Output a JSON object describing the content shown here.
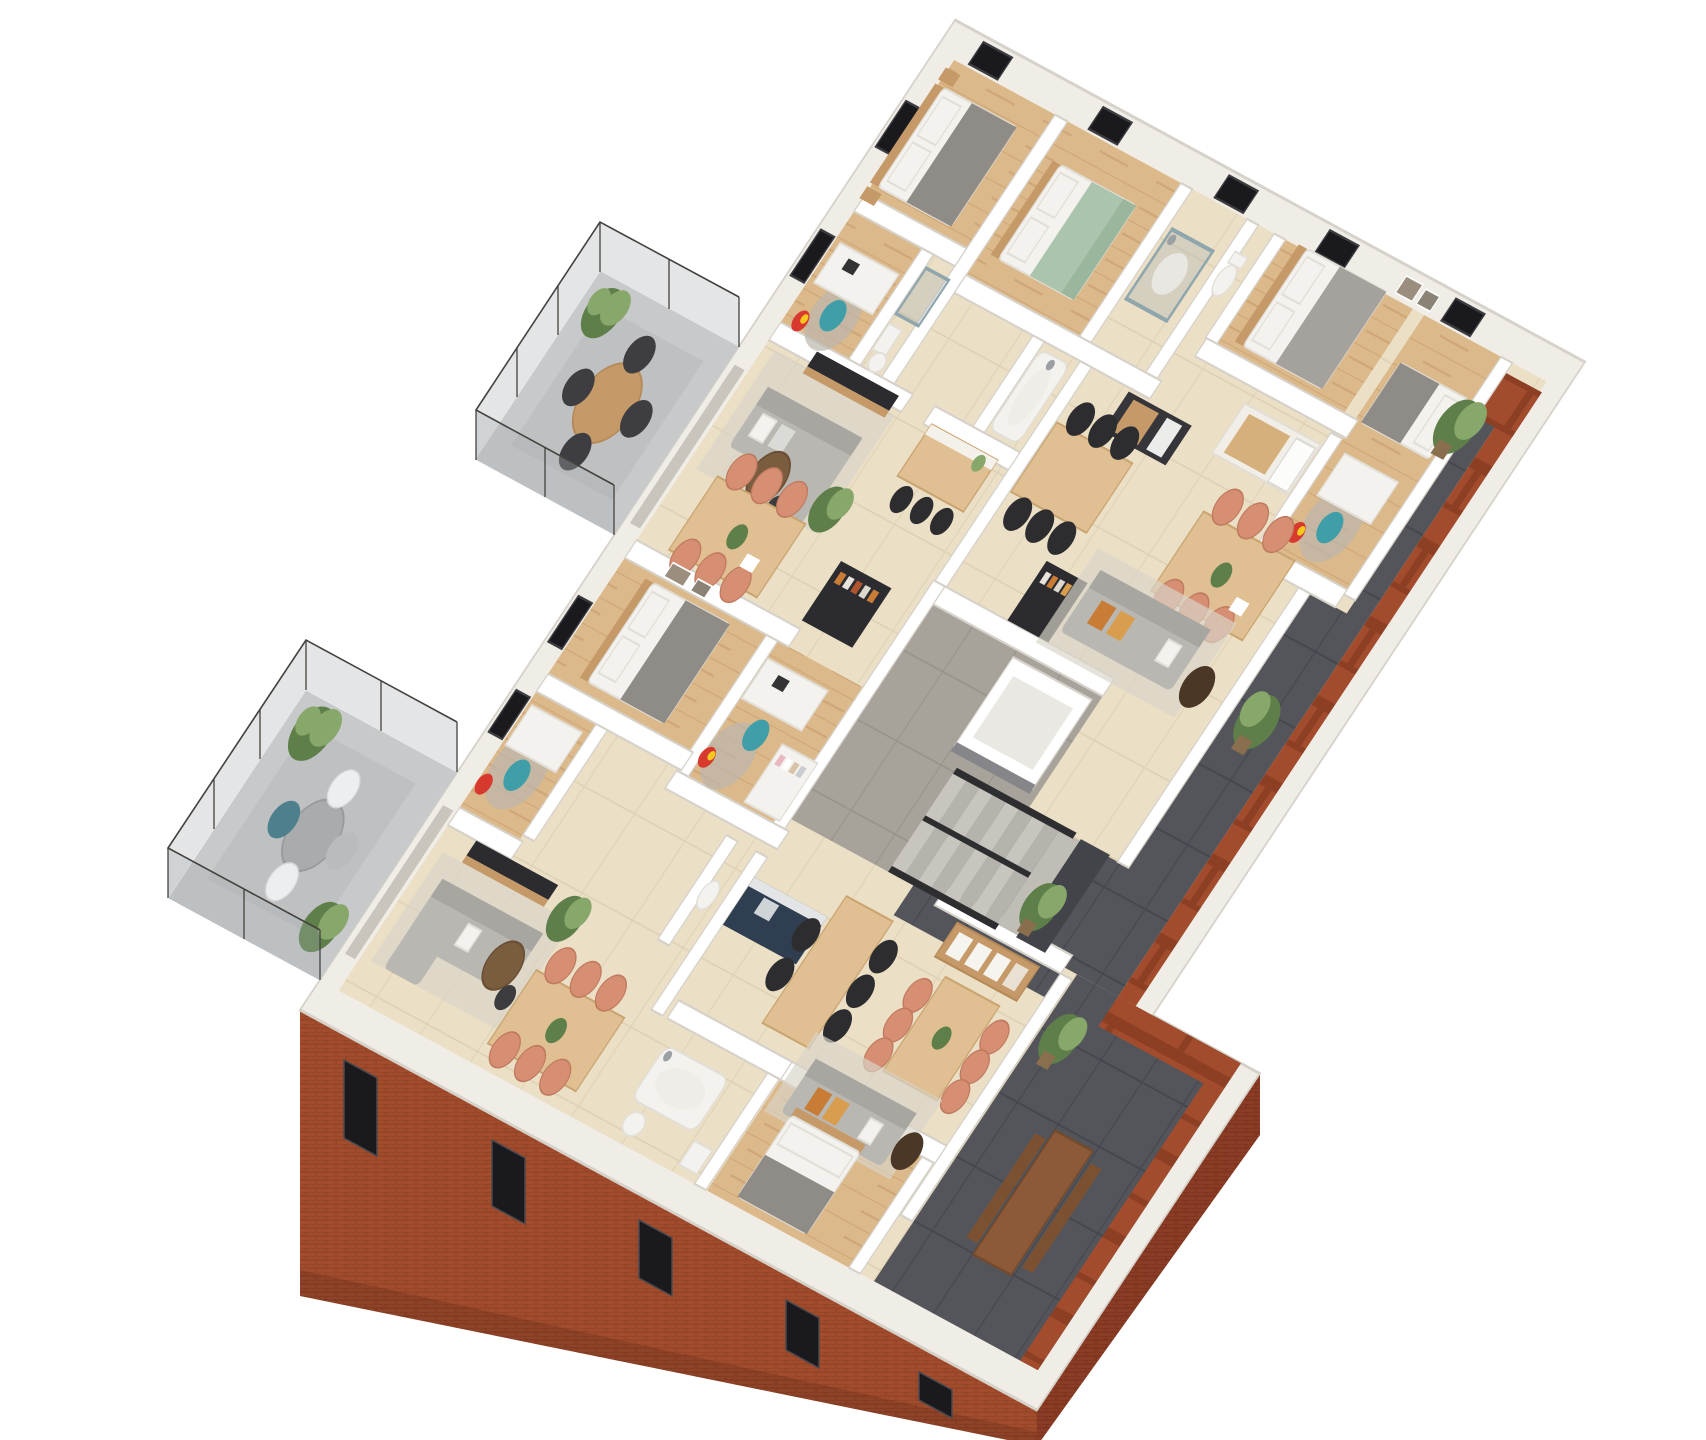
{
  "title": "3D isometric cutaway floor plan rendering of an apartment storey",
  "scene": {
    "description": "Photorealistic top-down 3D cutaway floor plan rotated diagonally: red brick exterior facade with dark windows, white interior walls, cream tile and light wood floors, two protruding glass-railed balconies on the left, anthracite tiled terraces along the right and bottom-right, a central concrete staircase with black railing and an elevator core, and fully furnished apartments.",
    "apartments": [
      {
        "id": "upper-left",
        "rooms": [
          "master bedroom with grey and white double bed",
          "kids room with white desk, teal chair and wardrobe",
          "bathroom",
          "living room with grey sofa and TV wall",
          "dining table with six salmon chairs",
          "wooden kitchen island with three black bar stools",
          "dark shelf cabinet",
          "glass balcony with round wooden table and four dark chairs"
        ]
      },
      {
        "id": "upper-right",
        "rooms": [
          "bedroom with green bed",
          "glass shower room",
          "toilet",
          "double bedroom with white bed and wall art",
          "kids bedroom with single bed, desk and beach ball",
          "dark kitchen block",
          "white and wood kitchen wall with fridge",
          "wooden dining table with black chairs",
          "dining table with salmon chairs",
          "grey sofa with orange cushions",
          "dark wardrobe with clothes"
        ]
      },
      {
        "id": "lower",
        "rooms": [
          "master bedroom with double bed and wall art",
          "two kids rooms with desks, teal chairs and beach balls",
          "living room with grey corner sofa and TV wall",
          "dining table with six salmon chairs",
          "navy blue kitchen counter",
          "second wooden dining table with black chairs",
          "second dining table with salmon chairs",
          "lounge sofa with orange cushions",
          "wooden shelf unit",
          "bathroom with bathtub, toilet and basin",
          "rear bedroom with grey bed",
          "glass balcony with round table, white and teal chairs"
        ]
      }
    ],
    "common_areas": [
      "grey tiled corridor",
      "concrete staircase with black railings",
      "elevator shaft",
      "anthracite tile terraces with green shrub planters",
      "timber outdoor dining set on rear terrace"
    ],
    "counts": {
      "balconies": 2,
      "terrace_plants": 7,
      "facade_windows_bottom": 5,
      "facade_windows_top_edge": 5
    }
  },
  "palette": {
    "bg": "#ffffff",
    "band": "#f0ede7",
    "wall": "#ffffff",
    "wallEdge": "#d6d2ca",
    "tile": "#ebdfc6",
    "tileLine": "#e0d2b4",
    "wood": "#dcb98a",
    "woodDark": "#c59a68",
    "corridor": "#a7a39b",
    "terrace": "#54555a",
    "terraceLine": "#464850",
    "balcony": "#c8c9cb",
    "balconyRug": "#bfc0c2",
    "brick": "#a24c2d",
    "brickShadow": "#8d3f24",
    "brickDark": "#8a3c24",
    "glassFill": "rgba(168,173,177,0.32)",
    "glassFrame": "#44423e",
    "sofa": "#b9b7b1",
    "sofaDark": "#a8a6a0",
    "rug": "#d9d4c8",
    "cushionOrange1": "#c87c35",
    "cushionOrange2": "#d99d4e",
    "tableWood": "#e0bf92",
    "chairSalmon": "#d78f74",
    "chairBlack": "#2d2d30",
    "chairTeal": "#3f9ea8",
    "kitchenNavy": "#2f3e50",
    "furnitureDark": "#2c2c30",
    "bedWhite": "#f4f2ee",
    "bedGray": "#8f8c88",
    "bedGreen": "#abc4ae",
    "plantDark": "#5e7f49",
    "plantLight": "#87a86a",
    "plantPot": "#8a6f4f",
    "metal": "#2e2e30",
    "window": "#1a1a1e",
    "stair": "#c8c5bf",
    "outdoorWood": "#8c5a38"
  }
}
